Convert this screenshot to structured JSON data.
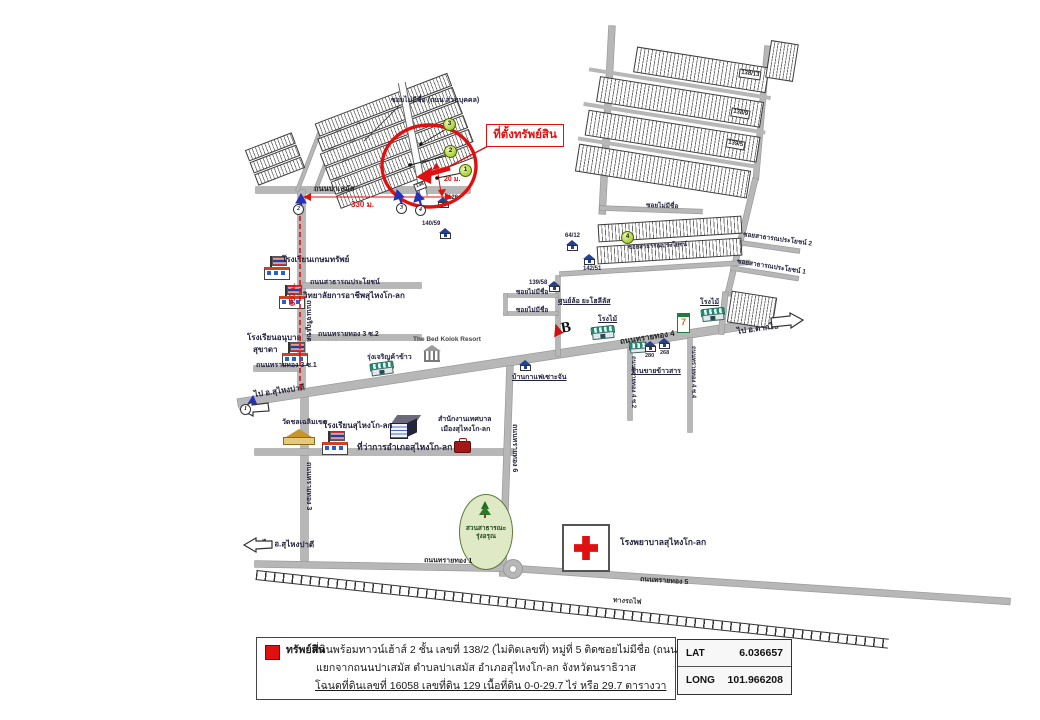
{
  "map": {
    "callout": "ที่ตั้งทรัพย์สิน",
    "top_soi": "ซอยไม่มีชื่อ (ถนน ส่วนบุคคล)",
    "roads": {
      "pasemas": "ถนนปาเสมัส",
      "charoenkhet": "ถนนเจริญเขต",
      "satharana": "ถนนสาธารณประโยชน์",
      "soi_satharana": "ซอยสาธารณประโยชน์",
      "st3_s2": "ถนนทรายทอง 3 ซ.2",
      "st3_s1": "ถนนทรายทอง 3 ซ.1",
      "st3": "ถนนทรายทอง 3",
      "st4": "ถนนทรายทอง 4",
      "st4_s2": "ถนนทรายทอง 4 ซ.2",
      "st4_s4": "ถนนทรายทอง 4 ซ.4",
      "st6": "ถนนทรายทอง 6",
      "st1": "ถนนทรายทอง 1",
      "st5": "ถนนทรายทอง 5",
      "soi_sp2": "ซอยสาธารณประโยชน์ 2",
      "soi_sp1": "ซอยสาธารณประโยชน์ 1",
      "soi_noname": "ซอยไม่มีชื่อ",
      "railway": "ทางรถไฟ",
      "to_padi": "ไป อ.สุไหงปาดี",
      "to_takbai": "ไป อ.ตากใบ"
    },
    "places": {
      "kasemsap": "โรงเรียนเกษมทรัพย์",
      "college": "วิทยาลัยการอาชีพสุไหงโก-ลก",
      "anuban1": "โรงเรียนอนุบาล",
      "anuban2": "สุขาดา",
      "kolok_school": "โรงเรียนสุไหงโก-ลก",
      "temple": "วัดชลเฉลิมเขต",
      "amphoe": "ที่ว่าการอำเภอสุไหงโก-ลก",
      "mun1": "สำนักงานเทศบาล",
      "mun2": "เมืองสุไหงโก-ลก",
      "rice_mill": "รุ่งเจริญค้าข้าว",
      "resort": "The Bed Kolok Resort",
      "tire": "ศูนย์ล้อ ยะโฮลีลัส",
      "tire_logo": "B",
      "wood": "โรงไม้",
      "rice_shop": "ร้านขายข้าวสาร",
      "coffee": "บ้านกาแฟเซาะจัน",
      "park1": "สวนสาธารณะ",
      "park2": "รุ่งอรุณ",
      "hospital": "โรงพยาบาลสุไหงโก-ลก",
      "seven": "7"
    },
    "houses": {
      "h128": "128",
      "h140_59": "140/59",
      "h64_12": "64/12",
      "h142_51": "142/51",
      "h139_58": "139/58",
      "h280": "280",
      "h268": "268",
      "p138_13": "138/13",
      "p138_9": "138/9",
      "p139_5": "139/5",
      "p138": "138"
    },
    "dims": {
      "d330": "330 ม.",
      "d650": "650 ม.",
      "d20": "20 ม."
    },
    "markers": {
      "g1": "1",
      "g2": "2",
      "g3": "3",
      "g4": "4",
      "r1": "1",
      "r2": "2",
      "r3": "3",
      "r4": "4"
    }
  },
  "legend": {
    "title": "ทรัพย์สิน",
    "line1": "ที่ดินพร้อมทาวน์เฮ้าส์ 2 ชั้น เลขที่ 138/2 (ไม่ติดเลขที่) หมู่ที่ 5 ติดซอยไม่มีชื่อ (ถนนส่วนบุคคล)",
    "line2": "แยกจากถนนปาเสมัส ตำบลปาเสมัส อำเภอสุไหงโก-ลก จังหวัดนราธิวาส",
    "line3": "โฉนดที่ดินเลขที่ 16058 เลขที่ดิน 129 เนื้อที่ดิน 0-0-29.7 ไร่ หรือ 29.7 ตารางวา"
  },
  "coords": {
    "lat_label": "LAT",
    "lat": "6.036657",
    "long_label": "LONG",
    "long": "101.966208"
  },
  "colors": {
    "accent_red": "#e01010",
    "road_gray": "#b7b7b7",
    "route_blue": "#2631b8",
    "marker_green": "#a4cc38"
  }
}
